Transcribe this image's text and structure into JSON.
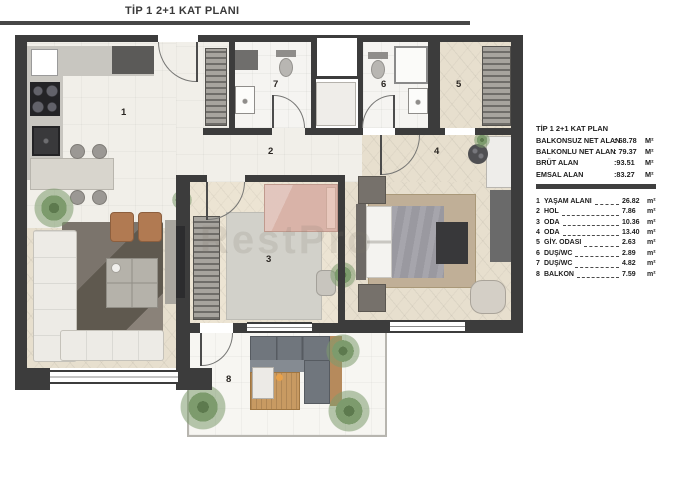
{
  "header": {
    "title": "TİP 1 2+1 KAT PLANI"
  },
  "watermark": "RestPro",
  "legend": {
    "title": "TİP 1 2+1 KAT PLAN",
    "areas": [
      {
        "label": "BALKONSUZ NET ALAN",
        "sep": ": ",
        "value": "68.78",
        "unit": "M²"
      },
      {
        "label": "BALKONLU NET ALAN",
        "sep": ": ",
        "value": "79.37",
        "unit": "M²"
      },
      {
        "label": "BRÜT ALAN",
        "sep": ":",
        "value": "93.51",
        "unit": "M²"
      },
      {
        "label": "EMSAL ALAN",
        "sep": ":",
        "value": "83.27",
        "unit": "M²"
      }
    ],
    "rooms": [
      {
        "num": "1",
        "label": "YAŞAM ALANI",
        "value": "26.82",
        "unit": "m²"
      },
      {
        "num": "2",
        "label": "HOL",
        "value": "7.86",
        "unit": "m²"
      },
      {
        "num": "3",
        "label": "ODA",
        "value": "10.36",
        "unit": "m²"
      },
      {
        "num": "4",
        "label": "ODA",
        "value": "13.40",
        "unit": "m²"
      },
      {
        "num": "5",
        "label": "GİY. ODASI",
        "value": "2.63",
        "unit": "m²"
      },
      {
        "num": "6",
        "label": "DUŞ/WC",
        "value": "2.89",
        "unit": "m²"
      },
      {
        "num": "7",
        "label": "DUŞ/WC",
        "value": "4.82",
        "unit": "m²"
      },
      {
        "num": "8",
        "label": "BALKON",
        "value": "7.59",
        "unit": "m²"
      }
    ]
  },
  "plan": {
    "room_numbers": [
      "1",
      "2",
      "3",
      "4",
      "5",
      "6",
      "7",
      "8"
    ]
  },
  "colors": {
    "wall": "#3c3c3c",
    "header_line": "#474747",
    "tile": "#f1efe9",
    "wood": "#e7dfce"
  }
}
